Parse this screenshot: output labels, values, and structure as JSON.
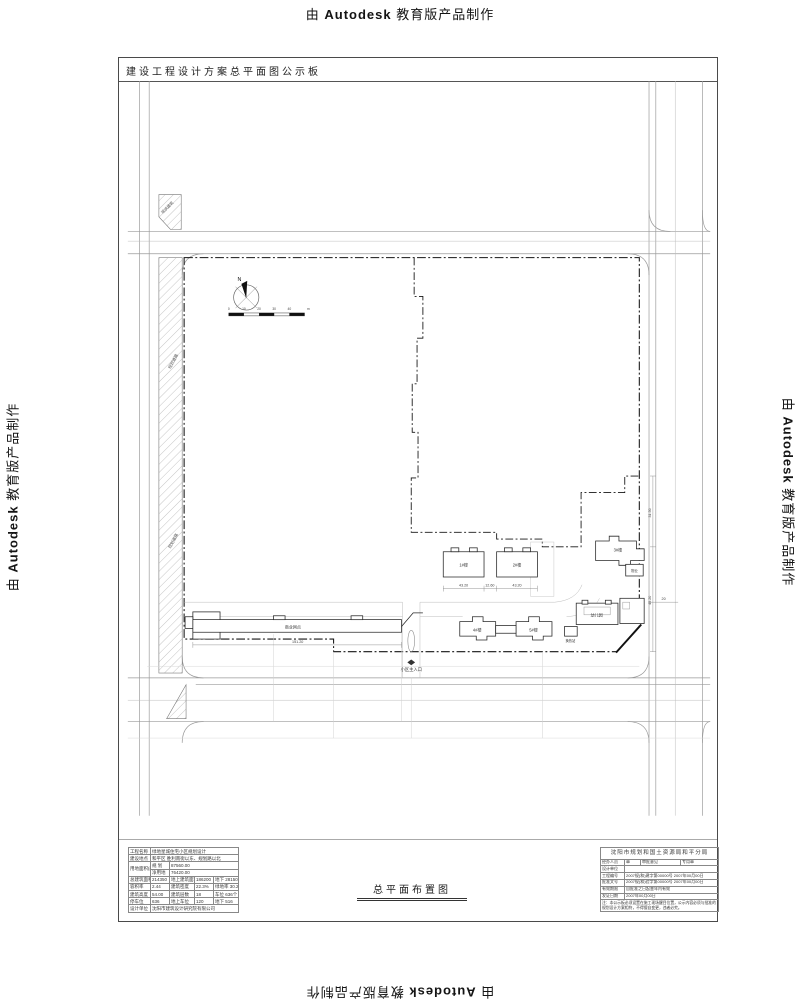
{
  "watermark": {
    "prefix": "由 ",
    "brand": "Autodesk",
    "suffix": " 教育版产品制作"
  },
  "frame": {
    "board_title": "建设工程设计方案总平面图公示板",
    "drawing_label": "总平面布置图"
  },
  "plan": {
    "north_label": "N",
    "scale_ticks": {
      "t0": "0",
      "t1": "10",
      "t2": "20",
      "t3": "30",
      "t4": "40",
      "unit": "m"
    },
    "entrance_label": "小区主入口",
    "road_strip_label": "规划道路",
    "corner_label": "现状建筑",
    "buildings": {
      "b1": "1#楼",
      "b2": "2#楼",
      "b3": "3#楼",
      "b4": "4#楼",
      "b5": "5#楼",
      "kindergarten": "幼儿园",
      "heat_station": "换热站",
      "shops": "商业网点",
      "property": "物业"
    },
    "dims": {
      "d1": "43.20",
      "d2": "12.60",
      "d3": "43.20",
      "d4": "31.50",
      "d5": "45.20",
      "d6": "20",
      "d7": "151.20"
    }
  },
  "info_table": {
    "r1l": "工程名称",
    "r1v": "绿地星城住宅小区规划设计",
    "r2l": "建设地点",
    "r2v": "和平区 胜利南街以东、规划路以北",
    "r3l": "用地面积(m²)",
    "r3a": "规 划",
    "r3av": "87560.00",
    "r3b": "净用地",
    "r3bv": "76420.00",
    "r4l": "总建筑面积",
    "r4v": "214350",
    "r4l2": "地上建筑面积",
    "r4v2": "186200",
    "r4r": "地下 28150",
    "r5l": "容积率",
    "r5v": "2.44",
    "r5l2": "建筑密度",
    "r5v2": "22.3%",
    "r5r": "绿地率 30.2%",
    "r6l": "建筑高度",
    "r6v": "54.00",
    "r6l2": "建筑层数",
    "r6v2": "18",
    "r6r": "车位 636个",
    "r7l": "停车位",
    "r7v": "636",
    "r7l2": "地上车位",
    "r7v2": "120",
    "r7r": "地下 516",
    "r8l": "设计单位",
    "r8v": "沈阳市建筑设计研究院有限公司"
  },
  "approval_block": {
    "header": "沈阳市规划和国土资源局和平分局",
    "c1": "经办人员",
    "c2": "章",
    "c3": "审批意见",
    "c4": "专用章",
    "r2l": "设计单位",
    "r2v": "",
    "r3l": "工程编号",
    "r3v": "2007规(和)建字第00000号 2007年00月00日",
    "r4l": "批准文号",
    "r4v": "2007规(和)验字第00000号 2007年00月00日",
    "r5l": "有效期限",
    "r5v": "自批准之日起壹年内有效",
    "r6l": "发证日期",
    "r6v": "2007年00月00日",
    "note": "注：本公示板必须设置在施工现场醒目位置，公示内容必须与批准的规划设计方案相符，不得擅自变更，违者必究。"
  }
}
